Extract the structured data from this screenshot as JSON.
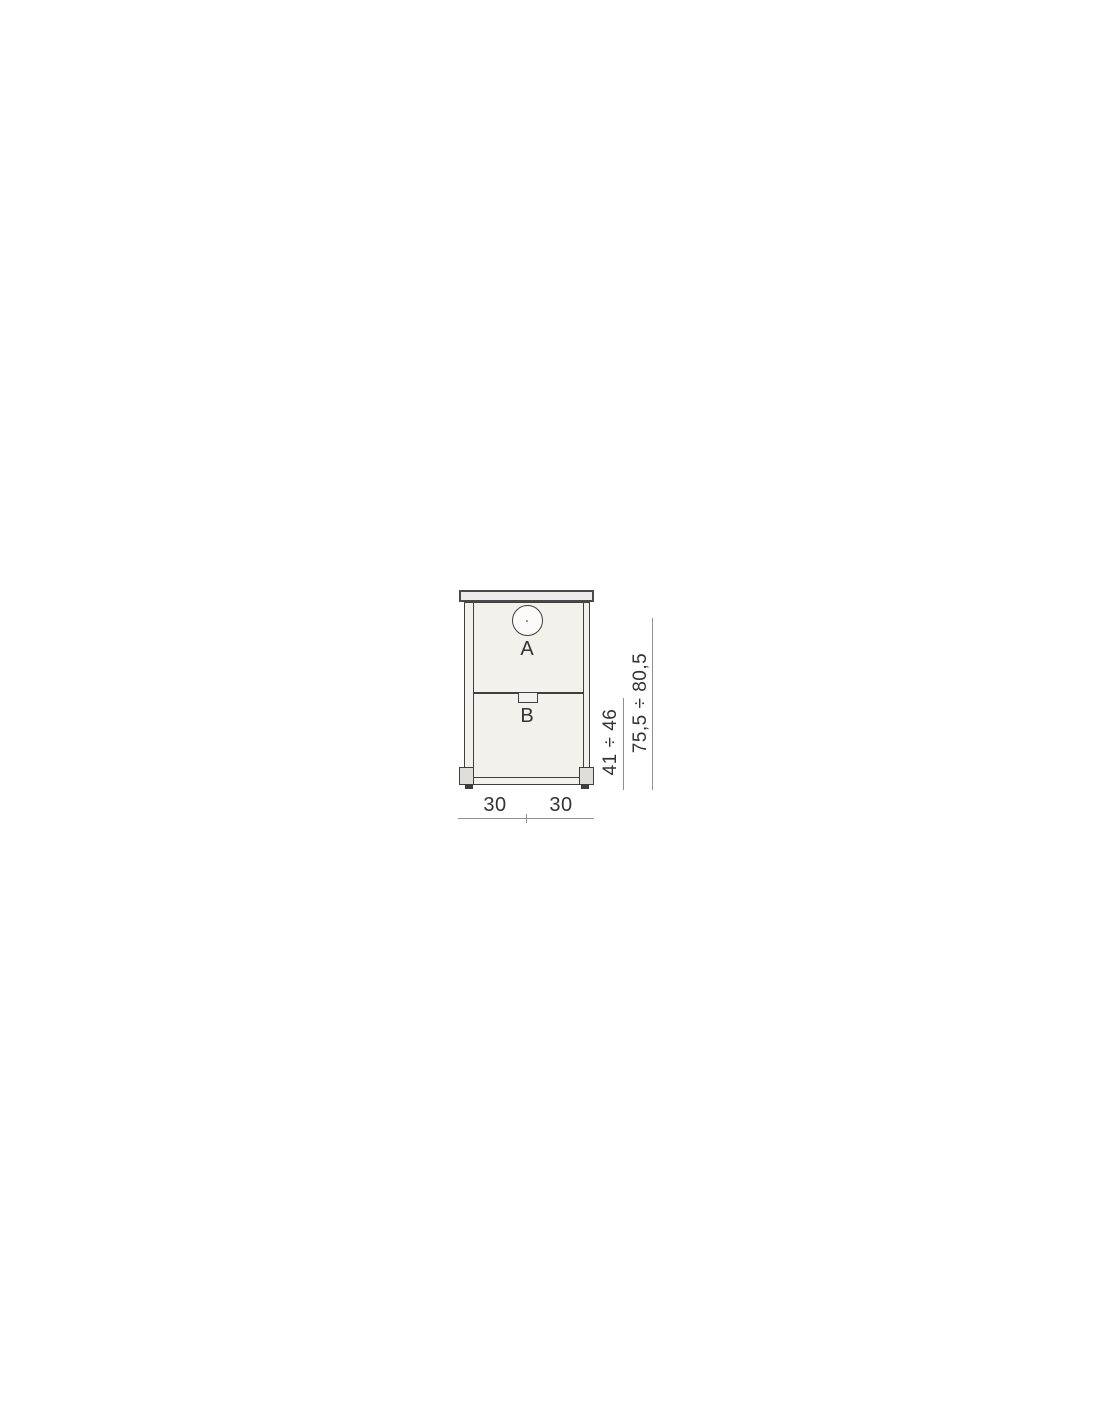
{
  "diagram": {
    "type": "technical-drawing-front-view",
    "labels": {
      "hole": "A",
      "notch": "B"
    },
    "dimensions": {
      "lower_height": "41 ÷ 46",
      "total_height": "75,5 ÷ 80,5",
      "width_left": "30",
      "width_right": "30"
    }
  },
  "colors": {
    "background": "#ffffff",
    "outline": "#3f3f3f",
    "outline_dark": "#4a4a4a",
    "dimension_line": "#8f8f8f",
    "panel_fill": "#edebe9",
    "body_fill": "#f3f1ec",
    "foot_fill": "#e0ded9",
    "text": "#333333"
  }
}
